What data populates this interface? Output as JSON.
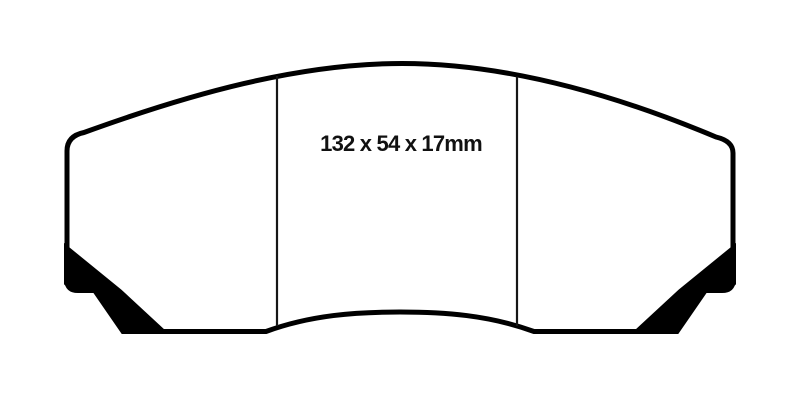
{
  "page": {
    "background": "#ffffff"
  },
  "diagram": {
    "subject": "brake-pad-front-profile",
    "dimensions_label": "132 x 54 x 17mm",
    "colors": {
      "ink": "#000000",
      "background": "#ffffff"
    }
  }
}
